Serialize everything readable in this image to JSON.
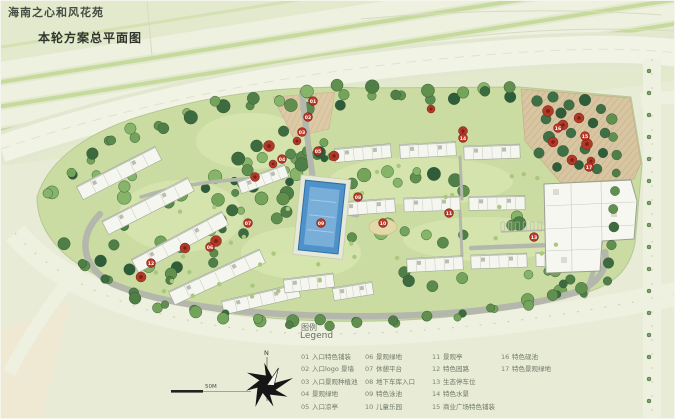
{
  "page": {
    "title": "海南之心和风花苑",
    "subtitle": "本轮方案总平面图"
  },
  "legend": {
    "title_zh": "图例",
    "title_en": "Legend",
    "items": [
      {
        "num": "01",
        "label": "入口特色铺装"
      },
      {
        "num": "02",
        "label": "入口logo 景墙"
      },
      {
        "num": "03",
        "label": "入口景观种植池"
      },
      {
        "num": "04",
        "label": "景观绿地"
      },
      {
        "num": "05",
        "label": "入口凉亭"
      },
      {
        "num": "06",
        "label": "景观绿地"
      },
      {
        "num": "07",
        "label": "休憩平台"
      },
      {
        "num": "08",
        "label": "地下车库入口"
      },
      {
        "num": "09",
        "label": "特色泳池"
      },
      {
        "num": "10",
        "label": "儿童乐园"
      },
      {
        "num": "11",
        "label": "景观亭"
      },
      {
        "num": "12",
        "label": "特色园路"
      },
      {
        "num": "13",
        "label": "生态停车位"
      },
      {
        "num": "14",
        "label": "特色水景"
      },
      {
        "num": "15",
        "label": "商业广场特色铺装"
      },
      {
        "num": "16",
        "label": "特色砚池"
      },
      {
        "num": "17",
        "label": "特色景观绿地"
      }
    ]
  },
  "compass": {
    "north_label": "N"
  },
  "scale_bar": {
    "label": "50M"
  },
  "markers": [
    {
      "num": "01",
      "x": 312,
      "y": 100
    },
    {
      "num": "02",
      "x": 307,
      "y": 116
    },
    {
      "num": "03",
      "x": 301,
      "y": 131
    },
    {
      "num": "04",
      "x": 281,
      "y": 158
    },
    {
      "num": "05",
      "x": 317,
      "y": 150
    },
    {
      "num": "06",
      "x": 209,
      "y": 246
    },
    {
      "num": "07",
      "x": 247,
      "y": 222
    },
    {
      "num": "08",
      "x": 357,
      "y": 196
    },
    {
      "num": "09",
      "x": 320,
      "y": 222
    },
    {
      "num": "10",
      "x": 382,
      "y": 222
    },
    {
      "num": "11",
      "x": 448,
      "y": 212
    },
    {
      "num": "12",
      "x": 150,
      "y": 262
    },
    {
      "num": "13",
      "x": 533,
      "y": 236
    },
    {
      "num": "14",
      "x": 462,
      "y": 137
    },
    {
      "num": "15",
      "x": 584,
      "y": 135
    },
    {
      "num": "16",
      "x": 557,
      "y": 127
    },
    {
      "num": "17",
      "x": 588,
      "y": 166
    }
  ],
  "colors": {
    "background": "#e8ecd6",
    "site_green": "#cbdca2",
    "road_gray": "#b4b7ac",
    "corridor": "#f0f2e3",
    "pool_blue": "#4e92c9",
    "pool_light": "#79aed8",
    "plaza_tan": "#d8c6a3",
    "marker_red": "#c03a2a",
    "red_tree": "#b03a2a",
    "building_white": "#f6f6f0",
    "tree_dark": "#3d6b3f"
  }
}
